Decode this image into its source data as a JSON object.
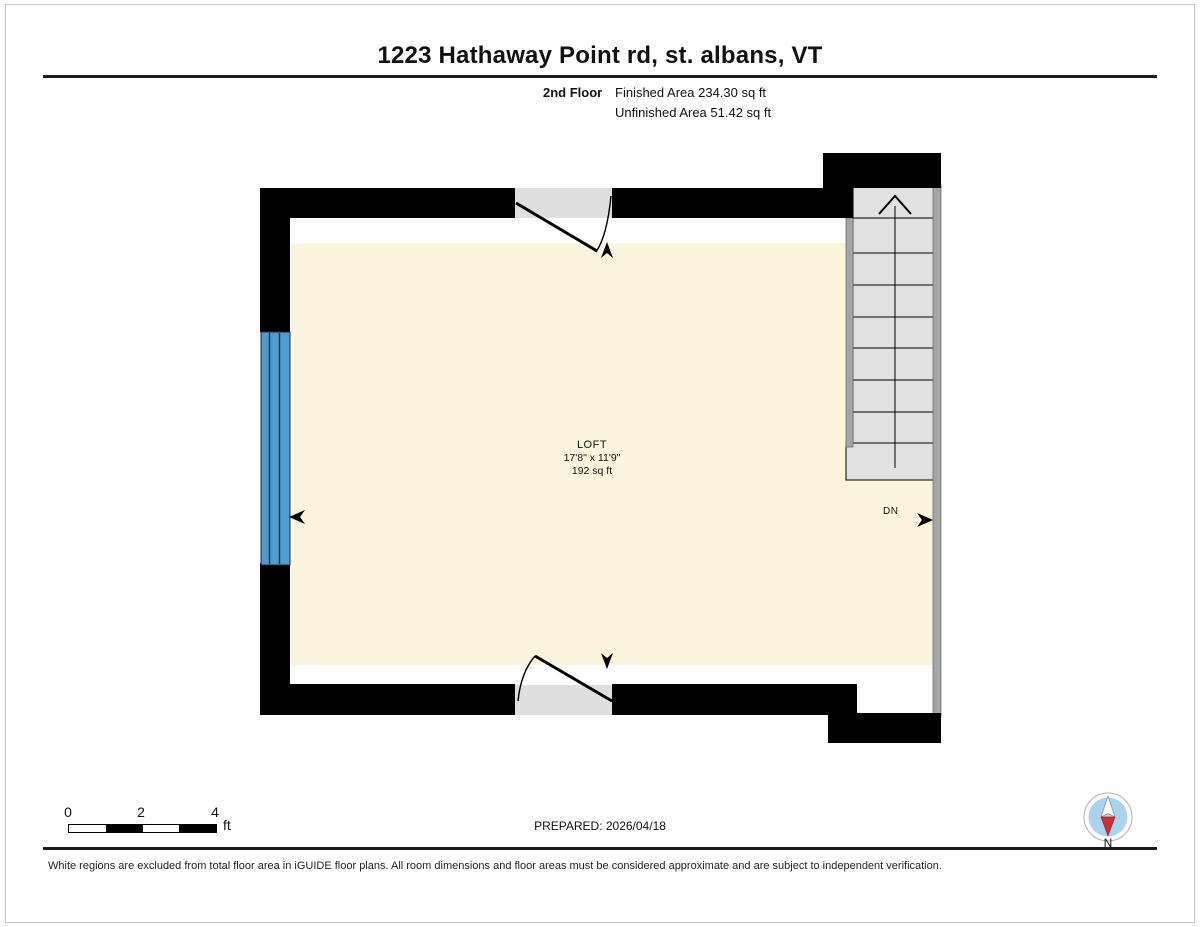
{
  "header": {
    "title": "1223 Hathaway Point rd, st. albans, VT",
    "floor_label": "2nd Floor",
    "finished_area": "Finished Area 234.30 sq ft",
    "unfinished_area": "Unfinished Area 51.42 sq ft"
  },
  "floor_plan": {
    "room": {
      "name": "LOFT",
      "dimensions": "17'8\" x 11'9\"",
      "area": "192 sq ft"
    },
    "stairs_direction_label": "DN"
  },
  "footer": {
    "scale": {
      "ticks": [
        "0",
        "2",
        "4"
      ],
      "unit": "ft"
    },
    "prepared": "PREPARED: 2026/04/18",
    "compass_label": "N",
    "disclaimer": "White regions are excluded from total floor area in iGUIDE floor plans. All room dimensions and floor areas must be considered approximate and are subject to independent verification."
  },
  "colors": {
    "wall": "#000000",
    "finished_area_fill": "#FBF5DE",
    "window": "#4E9CD1",
    "stairs_fill": "#E1E1E1",
    "thin_wall": "#A5A5A5",
    "door_opening": "#DFDFDF",
    "compass_blue": "#A9D3EE",
    "compass_red": "#D22B2B"
  }
}
